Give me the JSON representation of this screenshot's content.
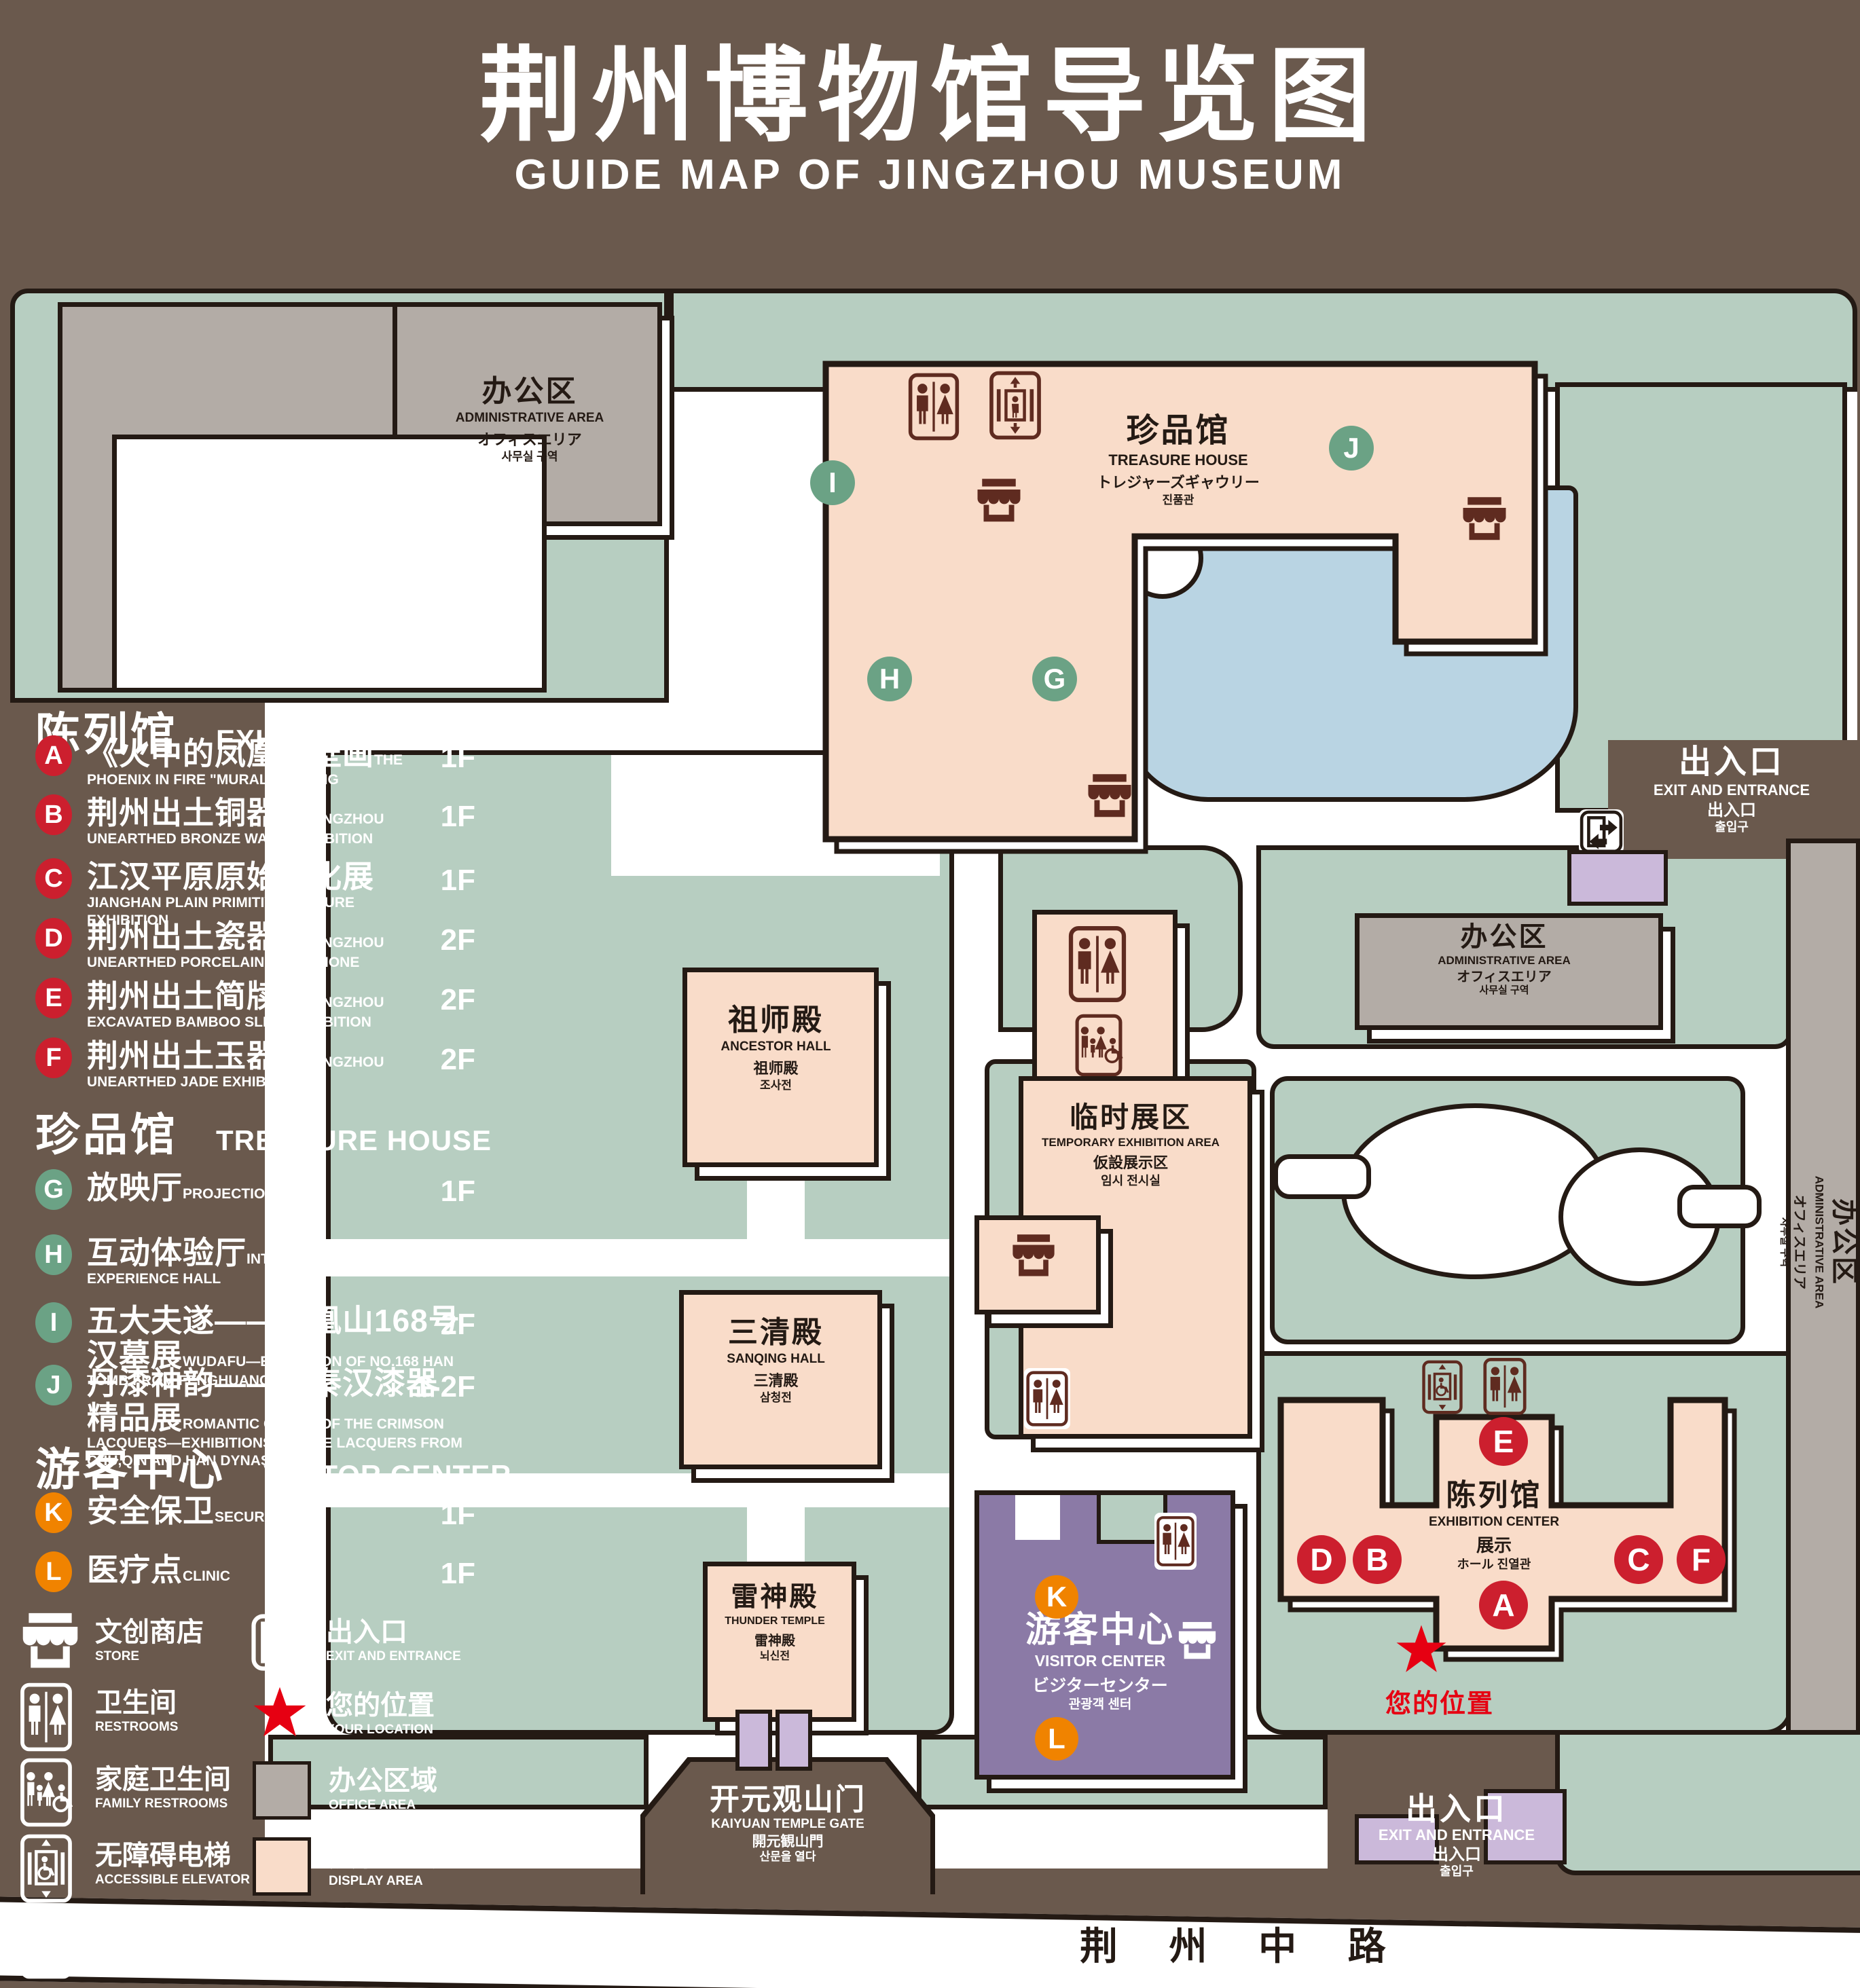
{
  "title": {
    "zh": "荆州博物馆导览图",
    "en": "GUIDE MAP OF JINGZHOU MUSEUM"
  },
  "legend": {
    "sections": [
      {
        "zh": "陈列馆",
        "en": "EXHIBITION CENTER",
        "items": [
          {
            "key": "A",
            "zh": "《火中的凤凰》壁画",
            "en": "THE PHOENIX IN FIRE \"MURAL PAINTING",
            "floor": "1F"
          },
          {
            "key": "B",
            "zh": "荆州出土铜器展",
            "en": "JINGZHOU UNEARTHED BRONZE WARE EXHIBITION",
            "floor": "1F"
          },
          {
            "key": "C",
            "zh": "江汉平原原始文化展",
            "en": "JIANGHAN PLAIN PRIMITIVE CULTURE EXHIBITION",
            "floor": "1F"
          },
          {
            "key": "D",
            "zh": "荆州出土瓷器展",
            "en": "JINGZHOU UNEARTHED PORCELAIN EXHIBITIONE",
            "floor": "2F"
          },
          {
            "key": "E",
            "zh": "荆州出土简牍展",
            "en": "JINGZHOU EXCAVATED BAMBOO SLIPS EXHIBITION",
            "floor": "2F"
          },
          {
            "key": "F",
            "zh": "荆州出土玉器展",
            "en": "JINGZHOU UNEARTHED JADE EXHIBITION",
            "floor": "2F"
          }
        ]
      },
      {
        "zh": "珍品馆",
        "en": "TREASURE HOUSE",
        "items": [
          {
            "key": "G",
            "zh": "放映厅",
            "en": "PROJECTION HALL",
            "floor": "1F"
          },
          {
            "key": "H",
            "zh": "互动体验厅",
            "en": "INTERACTIVE EXPERIENCE HALL",
            "floor": "1F"
          },
          {
            "key": "I",
            "zh": "五大夫遂——凤凰山168号汉墓展",
            "en": "WUDAFU—EXHIBITION OF NO.168 HAN TOMB FROM FENGHUANGSHAN",
            "floor": "2F"
          },
          {
            "key": "J",
            "zh": "丹漆神韵——楚秦汉漆器精品展",
            "en": "ROMANTIC CHARM OF THE CRIMSON LACQUERS—EXHIBITIONS OF FINE LACQUERS FROM CHU,QIN AND HAN DYNASTIES",
            "floor": "1-2F"
          }
        ]
      },
      {
        "zh": "游客中心",
        "en": "VISITOR CENTER",
        "items": [
          {
            "key": "K",
            "zh": "安全保卫",
            "en": "SECURITY",
            "floor": "1F"
          },
          {
            "key": "L",
            "zh": "医疗点",
            "en": "CLINIC",
            "floor": "1F"
          }
        ]
      }
    ],
    "symbols": [
      {
        "name": "store",
        "zh": "文创商店",
        "en": "STORE"
      },
      {
        "name": "exit",
        "zh": "出入口",
        "en": "EXIT AND ENTRANCE"
      },
      {
        "name": "restrooms",
        "zh": "卫生间",
        "en": "RESTROOMS"
      },
      {
        "name": "your-location",
        "zh": "您的位置",
        "en": "YOUR LOCATION"
      },
      {
        "name": "family-restrooms",
        "zh": "家庭卫生间",
        "en": "FAMILY RESTROOMS"
      },
      {
        "name": "office-area",
        "zh": "办公区域",
        "en": "OFFICE AREA"
      },
      {
        "name": "accessible-elevator",
        "zh": "无障碍电梯",
        "en": "ACCESSIBLE ELEVATOR"
      },
      {
        "name": "display-area",
        "zh": "展示区域",
        "en": "DISPLAY AREA"
      },
      {
        "name": "elevator",
        "zh": "电梯",
        "en": "Elevator"
      }
    ]
  },
  "map": {
    "markers": [
      "A",
      "B",
      "C",
      "D",
      "E",
      "F",
      "G",
      "H",
      "I",
      "J",
      "K",
      "L"
    ],
    "bld": {
      "admin": {
        "zh": "办公区",
        "en": "ADMINISTRATIVE AREA",
        "ja": "オフィスエリア",
        "ko": "사무실 구역"
      },
      "treasure": {
        "zh": "珍品馆",
        "en": "TREASURE HOUSE",
        "ja": "トレジャーズギャウリー",
        "ko": "진품관"
      },
      "ancestor": {
        "zh": "祖师殿",
        "en": "ANCESTOR HALL",
        "ja": "祖师殿",
        "ko": "조사전"
      },
      "temporary": {
        "zh": "临时展区",
        "en": "TEMPORARY EXHIBITION AREA",
        "ja": "仮設展示区",
        "ko": "임시 전시실"
      },
      "sanqing": {
        "zh": "三清殿",
        "en": "SANQING HALL",
        "ja": "三清殿",
        "ko": "삼청전"
      },
      "thunder": {
        "zh": "雷神殿",
        "en": "THUNDER TEMPLE",
        "ja": "雷神殿",
        "ko": "뇌신전"
      },
      "visitor": {
        "zh": "游客中心",
        "en": "VISITOR CENTER",
        "ja": "ビジターセンター",
        "ko": "관광객 센터"
      },
      "exhibition": {
        "zh": "陈列馆",
        "en": "EXHIBITION CENTER",
        "ja": "展示",
        "ko": "ホール 진열관"
      },
      "gate": {
        "zh": "开元观山门",
        "en": "KAIYUAN TEMPLE GATE",
        "ja": "開元観山門",
        "ko": "산문을 열다"
      },
      "exit": {
        "zh": "出入口",
        "en": "EXIT AND ENTRANCE",
        "ja": "出入口",
        "ko": "출입구"
      }
    },
    "road": "荆 州 中 路",
    "your_location": "您的位置"
  },
  "colors": {
    "bg": "#6a594d",
    "green": "#b7cec1",
    "pink": "#f9dcc9",
    "gray": "#b3aca6",
    "lake": "#b9d4e3",
    "purple": "#8b7aa6",
    "lavender": "#cbb9da",
    "outline": "#241a14",
    "red": "#cc1f2e",
    "mgreen": "#6ba285",
    "orange": "#f08300",
    "maroon": "#5f2b20",
    "star": "#e60012"
  }
}
